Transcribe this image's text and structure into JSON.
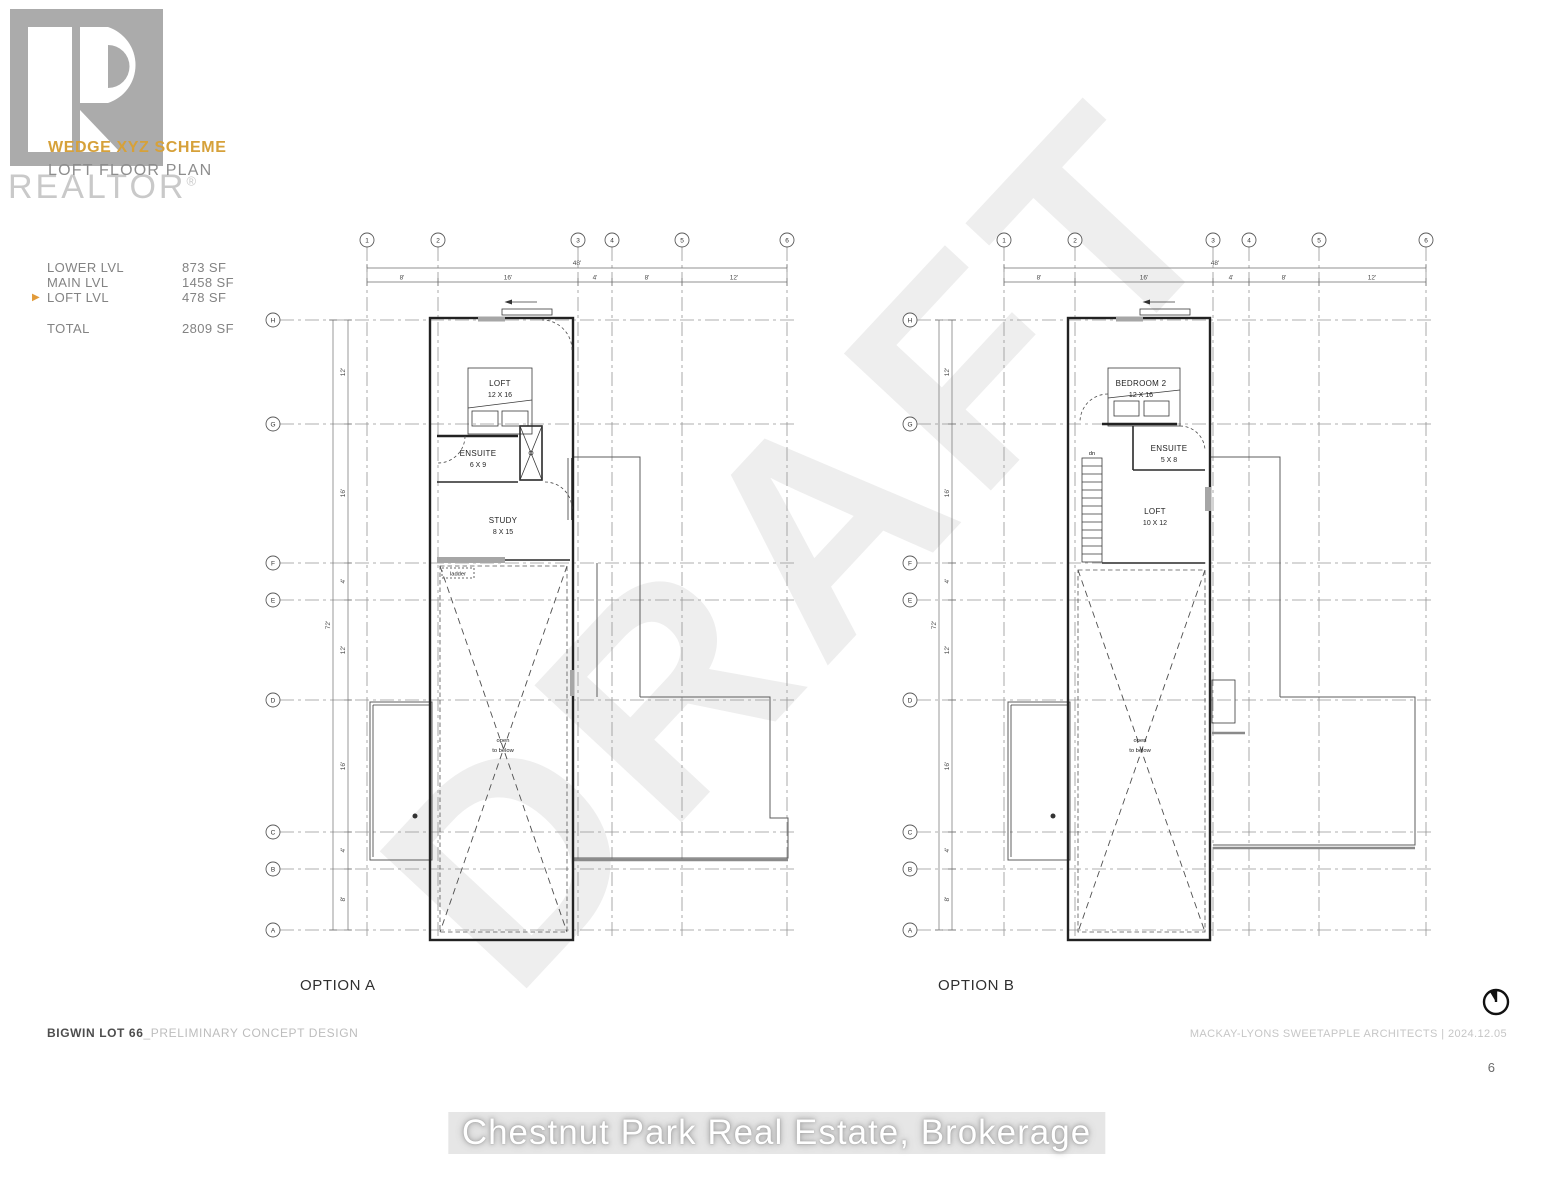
{
  "header": {
    "scheme_title": "WEDGE XYZ SCHEME",
    "subtitle": "LOFT FLOOR PLAN",
    "logo_word": "REALTOR",
    "logo_reg": "®"
  },
  "area_table": {
    "active_marker": "▶",
    "rows": [
      {
        "label": "LOWER LVL",
        "value": "873 SF"
      },
      {
        "label": "MAIN LVL",
        "value": "1458 SF"
      },
      {
        "label": "LOFT LVL",
        "value": "478 SF"
      }
    ],
    "total_label": "TOTAL",
    "total_value": "2809 SF"
  },
  "grid": {
    "columns": [
      "1",
      "2",
      "3",
      "4",
      "5",
      "6"
    ],
    "rows": [
      "H",
      "G",
      "F",
      "E",
      "D",
      "C",
      "B",
      "A"
    ],
    "col_dims": [
      "8'",
      "16'",
      "4'",
      "8'",
      "12'"
    ],
    "col_total": "48'",
    "row_dims": [
      "12'",
      "16'",
      "4'",
      "12'",
      "16'",
      "4'",
      "8'"
    ],
    "row_total": "72'"
  },
  "plans": [
    {
      "name": "OPTION A",
      "rooms": {
        "main": {
          "name": "LOFT",
          "size": "12 X 16"
        },
        "ensuite": {
          "name": "ENSUITE",
          "size": "6 X 9"
        },
        "third": {
          "name": "STUDY",
          "size": "8 X 15"
        }
      },
      "labels": {
        "ladder": "ladder",
        "open_1": "open",
        "open_2": "to below"
      }
    },
    {
      "name": "OPTION B",
      "rooms": {
        "main": {
          "name": "BEDROOM 2",
          "size": "12 X 16"
        },
        "ensuite": {
          "name": "ENSUITE",
          "size": "5 X 8"
        },
        "third": {
          "name": "LOFT",
          "size": "10 X 12"
        }
      },
      "labels": {
        "dn": "dn",
        "open_1": "open",
        "open_2": "to below"
      }
    }
  ],
  "footer": {
    "project_bold": "BIGWIN LOT 66",
    "project_rest": "_PRELIMINARY CONCEPT DESIGN",
    "architect_credit": "MACKAY-LYONS SWEETAPPLE ARCHITECTS | 2024.12.05",
    "page_number": "6"
  },
  "watermarks": {
    "draft": "DRAFT",
    "brokerage": "Chestnut Park Real Estate, Brokerage"
  },
  "colors": {
    "accent": "#d6a13a",
    "logo_gray": "#ababab"
  }
}
